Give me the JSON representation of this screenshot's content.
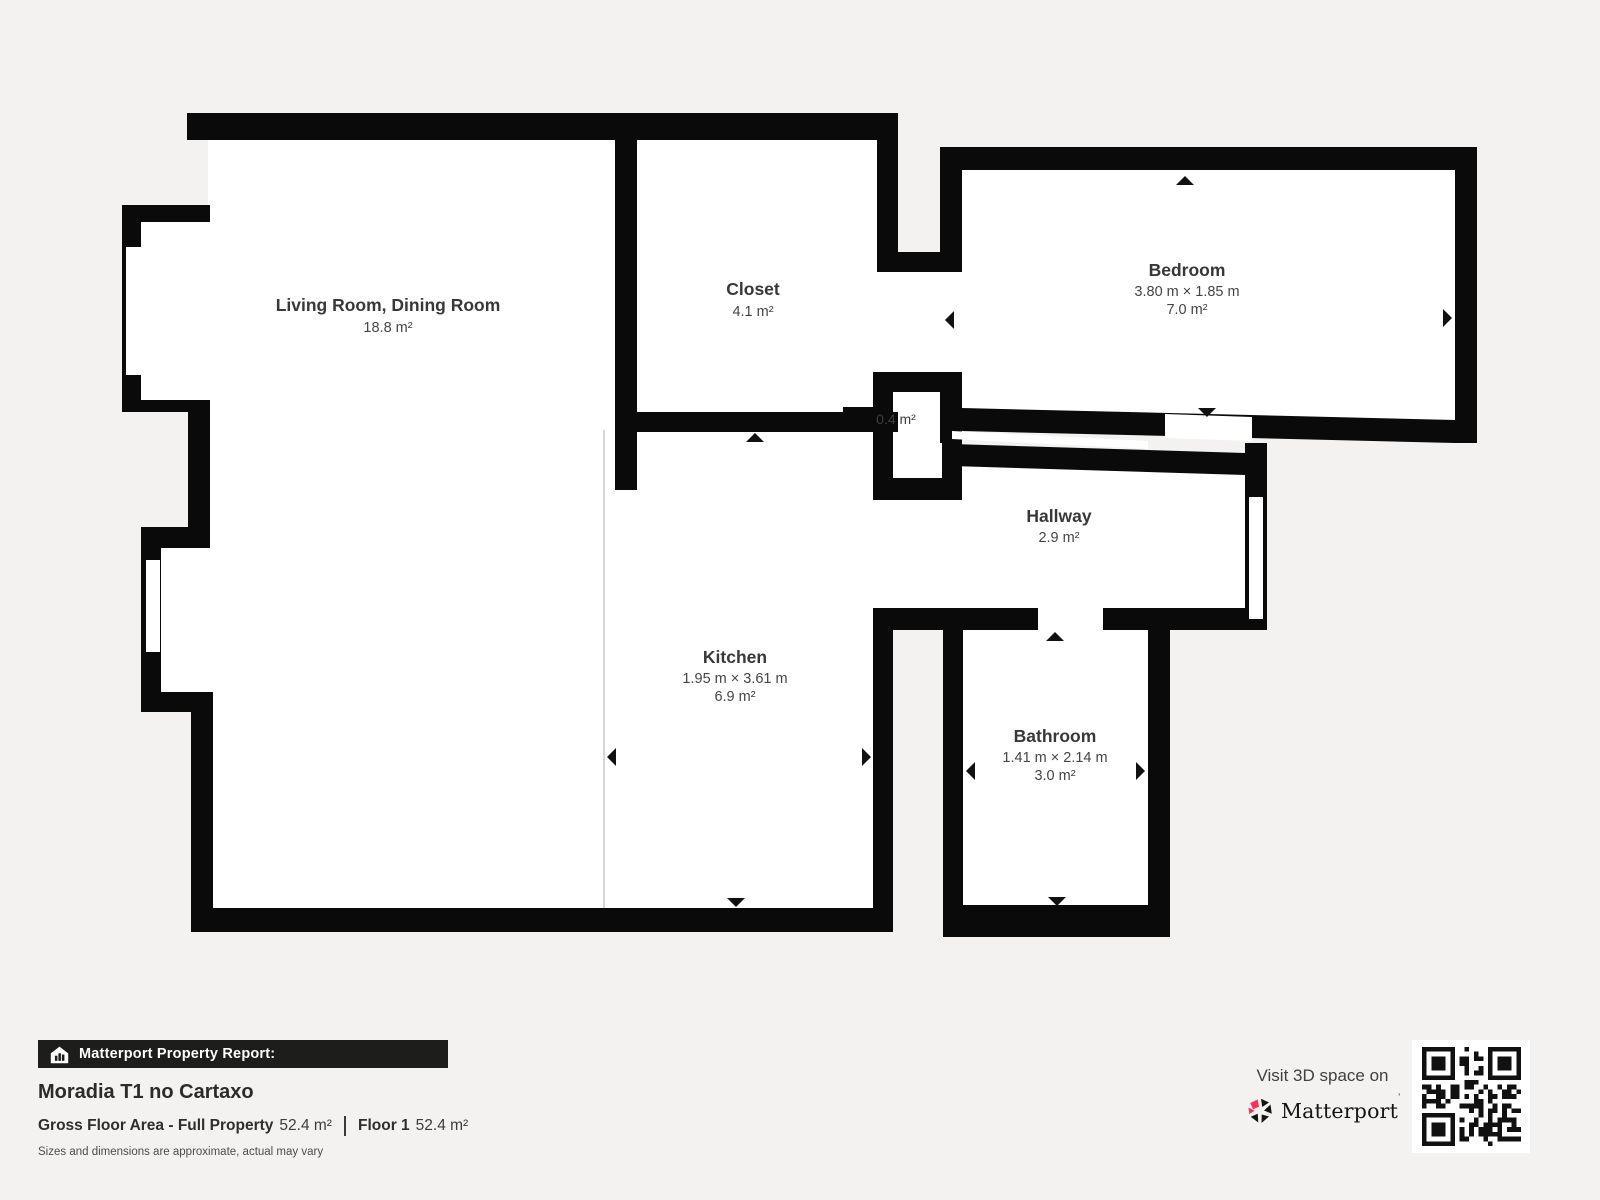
{
  "rooms": {
    "living": {
      "name": "Living Room, Dining Room",
      "area": "18.8 m²"
    },
    "closet": {
      "name": "Closet",
      "area": "4.1 m²"
    },
    "bedroom": {
      "name": "Bedroom",
      "dimensions": "3.80 m × 1.85 m",
      "area": "7.0 m²"
    },
    "small_closet": {
      "area": "0.4 m²"
    },
    "hallway": {
      "name": "Hallway",
      "area": "2.9 m²"
    },
    "kitchen": {
      "name": "Kitchen",
      "dimensions": "1.95 m × 3.61 m",
      "area": "6.9 m²"
    },
    "bathroom": {
      "name": "Bathroom",
      "dimensions": "1.41 m × 2.14 m",
      "area": "3.0 m²"
    }
  },
  "footer": {
    "report_label": "Matterport Property Report:",
    "property_title": "Moradia T1 no Cartaxo",
    "gross_area_label": "Gross Floor Area - Full Property",
    "gross_area_value": "52.4 m²",
    "floor_label": "Floor 1",
    "floor_area_value": "52.4 m²",
    "disclaimer": "Sizes and dimensions are approximate, actual may vary"
  },
  "promo": {
    "visit_text": "Visit 3D space on",
    "brand": "Matterport",
    "trademark": "’"
  },
  "icons": {
    "house": "house-with-bar-chart",
    "logo": "matterport-pinwheel",
    "qr": "qr-code",
    "extent_arrow": "triangle-extent-marker"
  },
  "colors": {
    "wall": "#0a0a0a",
    "bg": "#f4f2f0",
    "room": "#ffffff",
    "brand-red": "#ff3158",
    "text-dark": "#2b2b2b"
  }
}
